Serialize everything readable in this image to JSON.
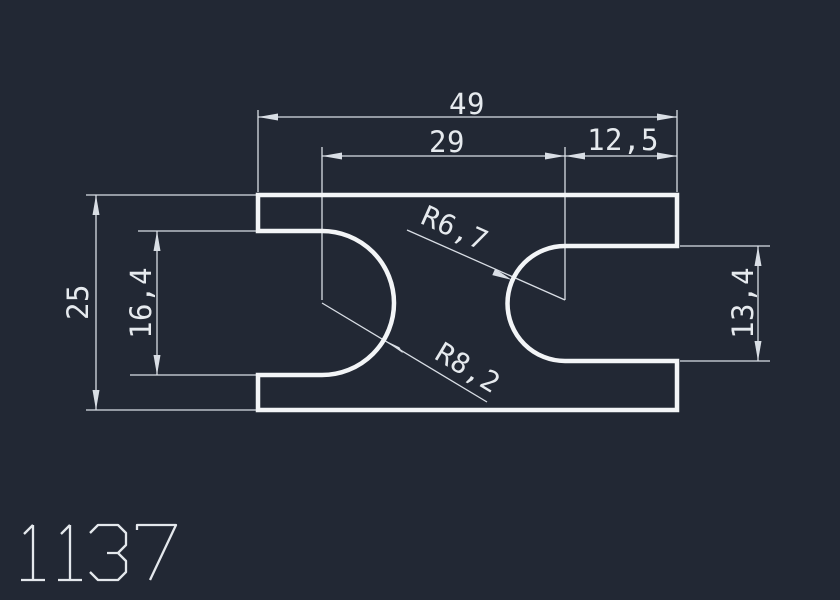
{
  "canvas": {
    "background_color": "#222834",
    "outline_color": "#f3f5f7",
    "dimension_color": "#d9dee5"
  },
  "drawing_number": "1137",
  "dimensions": {
    "total_width": "49",
    "center_to_center": "29",
    "right_offset": "12,5",
    "total_height": "25",
    "left_slot_height": "16,4",
    "right_slot_height": "13,4",
    "right_slot_radius": "R6,7",
    "left_slot_radius": "R8,2"
  }
}
